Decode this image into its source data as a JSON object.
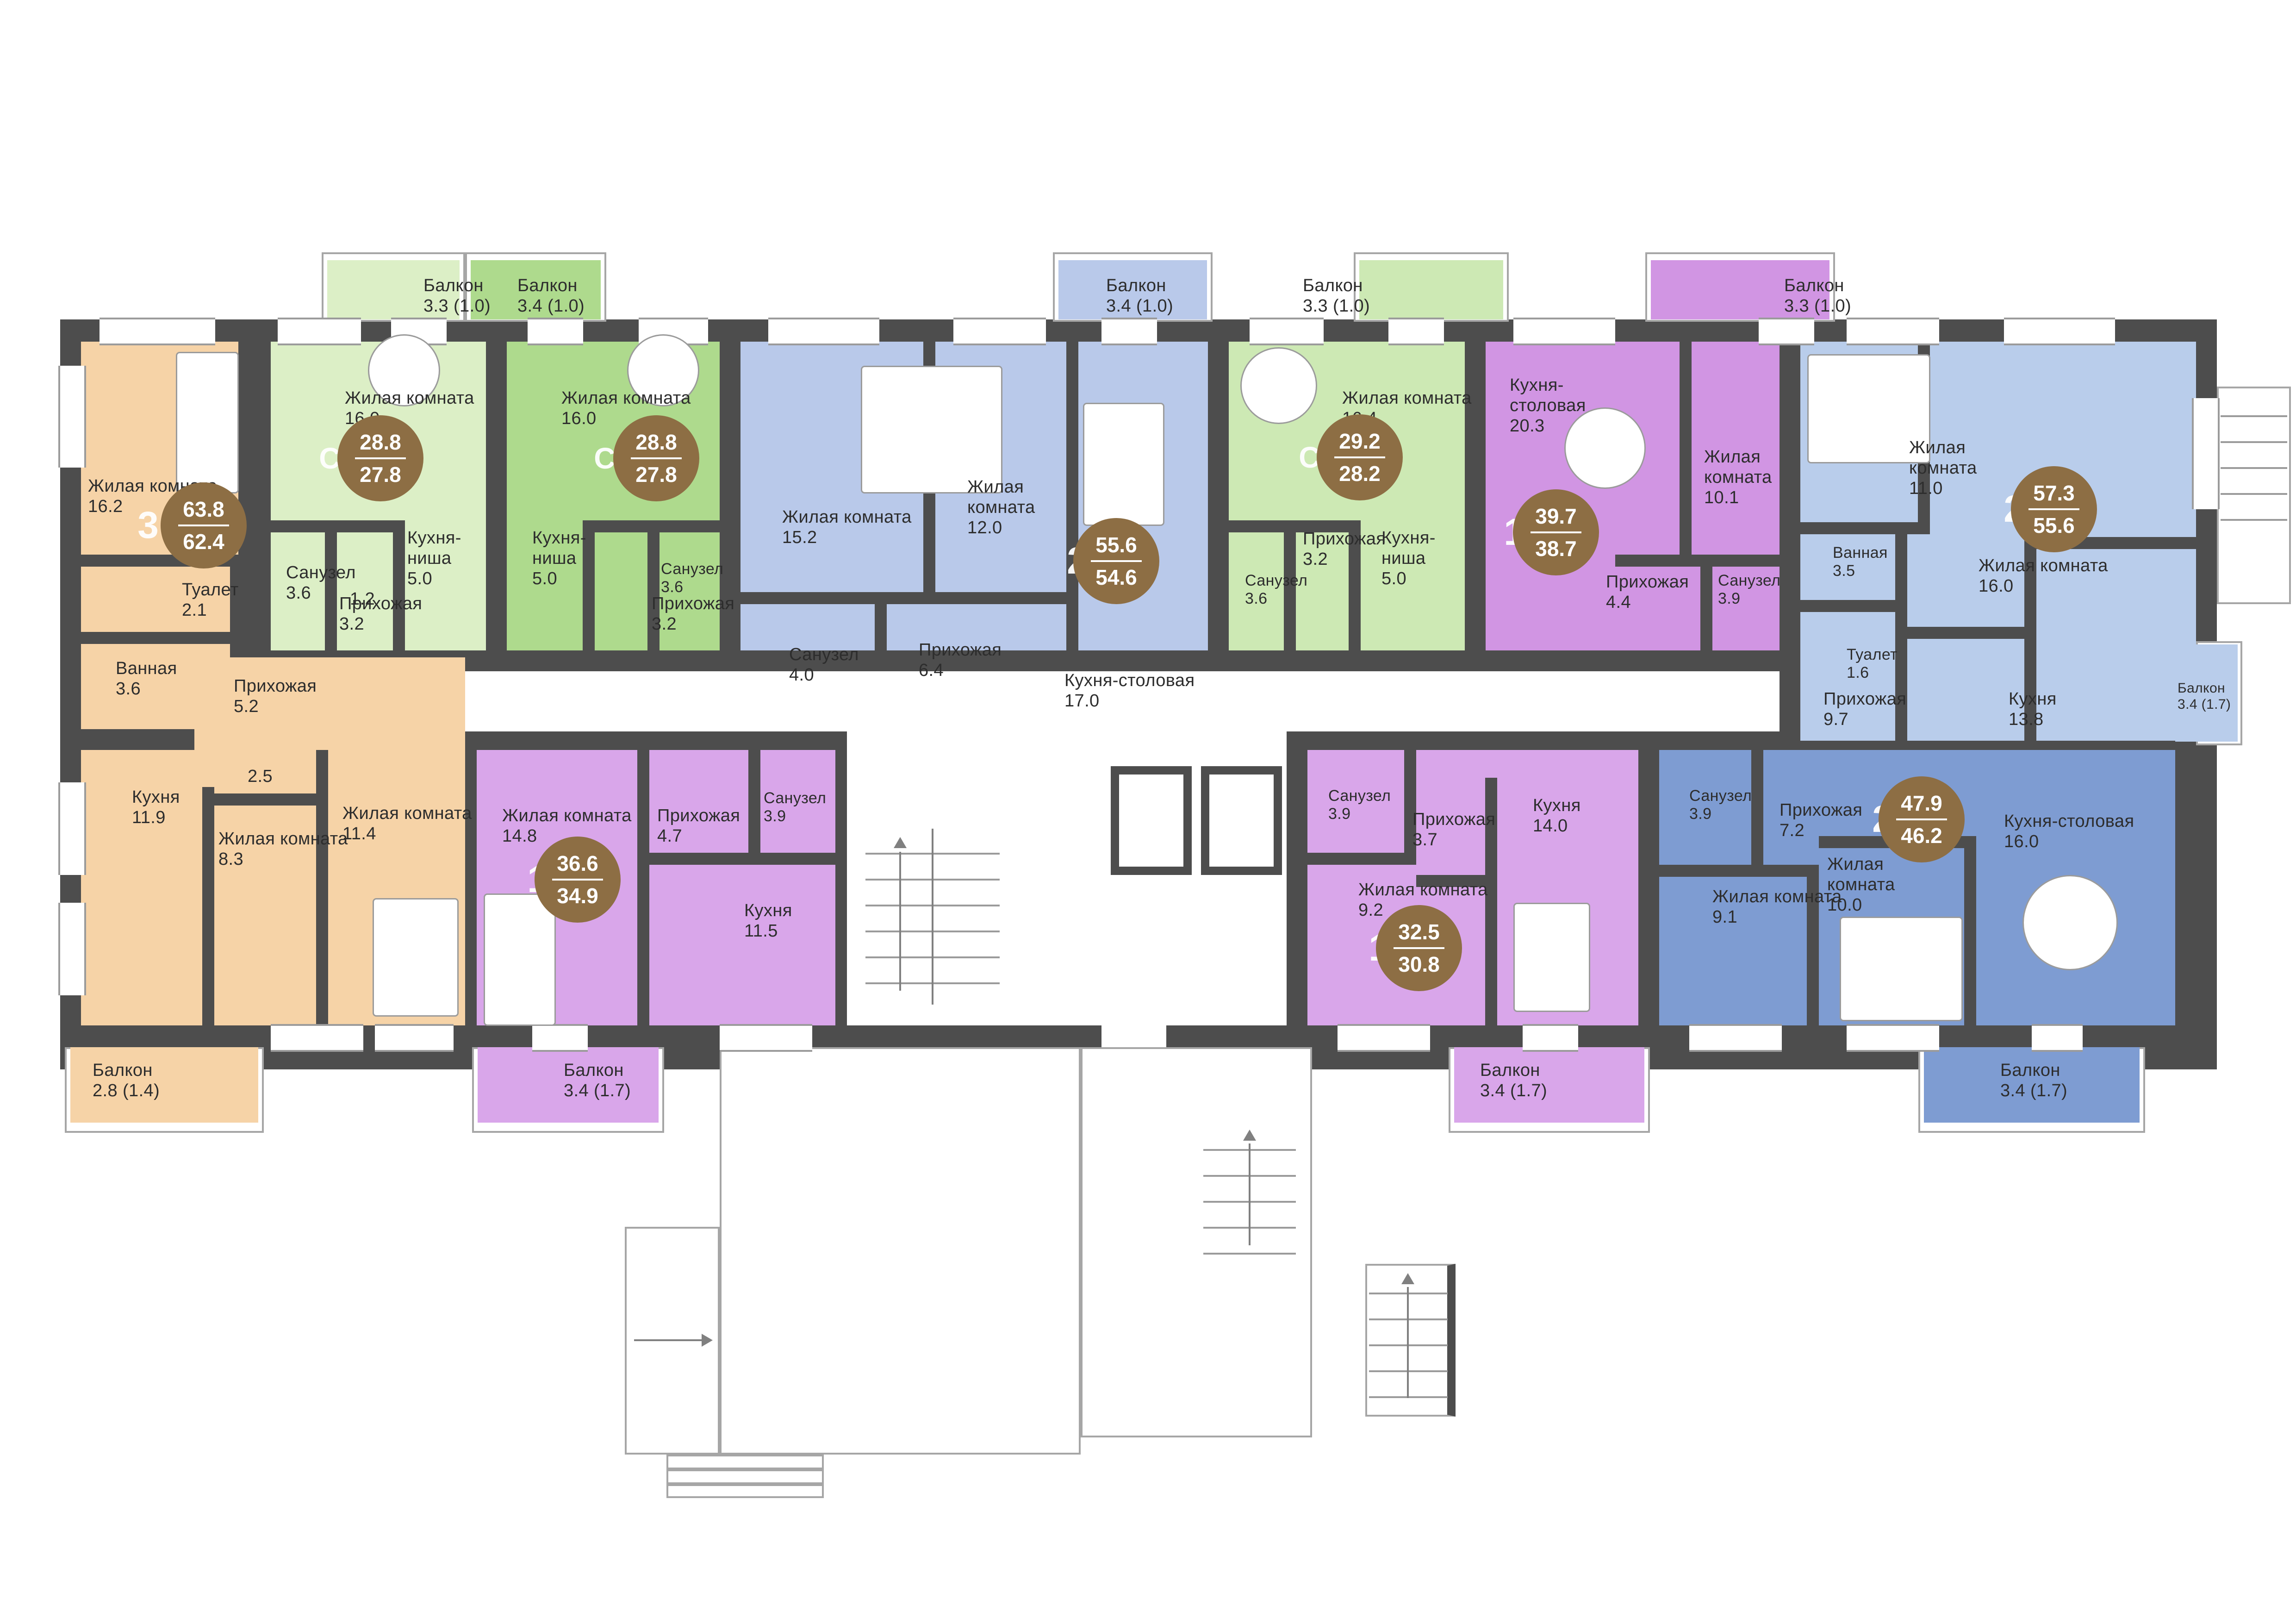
{
  "plan": {
    "background": "#ffffff",
    "wall_color": "#4d4d4d",
    "badge_color": "#8d6e44",
    "apartments": [
      {
        "id": "apt-3r-63-8",
        "type": "3",
        "area_total": "63.8",
        "area_living": "62.4",
        "color": "#f6d3a7",
        "rooms": [
          {
            "name": "Жилая комната",
            "area": "16.2"
          },
          {
            "name": "Туалет",
            "area": "2.1"
          },
          {
            "name": "",
            "area": "1.2"
          },
          {
            "name": "Ванная",
            "area": "3.6"
          },
          {
            "name": "Прихожая",
            "area": "5.2"
          },
          {
            "name": "",
            "area": "2.5"
          },
          {
            "name": "Кухня",
            "area": "11.9"
          },
          {
            "name": "Жилая комната",
            "area": "8.3"
          },
          {
            "name": "Жилая комната",
            "area": "11.4"
          },
          {
            "name": "Балкон",
            "area": "2.8 (1.4)"
          }
        ]
      },
      {
        "id": "apt-st-28-8-a",
        "type": "Ст",
        "area_total": "28.8",
        "area_living": "27.8",
        "color": "#dcefc6",
        "rooms": [
          {
            "name": "Балкон",
            "area": "3.3 (1.0)"
          },
          {
            "name": "Жилая комната",
            "area": "16.0"
          },
          {
            "name": "Санузел",
            "area": "3.6"
          },
          {
            "name": "Кухня-ниша",
            "area": "5.0"
          },
          {
            "name": "Прихожая",
            "area": "3.2"
          }
        ]
      },
      {
        "id": "apt-st-28-8-b",
        "type": "Ст",
        "area_total": "28.8",
        "area_living": "27.8",
        "color": "#aeda8d",
        "rooms": [
          {
            "name": "Балкон",
            "area": "3.4 (1.0)"
          },
          {
            "name": "Жилая комната",
            "area": "16.0"
          },
          {
            "name": "Кухня-ниша",
            "area": "5.0"
          },
          {
            "name": "Прихожая",
            "area": "3.2"
          },
          {
            "name": "Санузел",
            "area": "3.6"
          }
        ]
      },
      {
        "id": "apt-2r-55-6",
        "type": "2",
        "area_total": "55.6",
        "area_living": "54.6",
        "color": "#b9c9ea",
        "rooms": [
          {
            "name": "Балкон",
            "area": "3.4 (1.0)"
          },
          {
            "name": "Жилая комната",
            "area": "15.2"
          },
          {
            "name": "Жилая комната",
            "area": "12.0"
          },
          {
            "name": "Санузел",
            "area": "4.0"
          },
          {
            "name": "Прихожая",
            "area": "6.4"
          },
          {
            "name": "Кухня-столовая",
            "area": "17.0"
          }
        ]
      },
      {
        "id": "apt-st-29-2",
        "type": "Ст",
        "area_total": "29.2",
        "area_living": "28.2",
        "color": "#cde9b4",
        "rooms": [
          {
            "name": "Балкон",
            "area": "3.3 (1.0)"
          },
          {
            "name": "Жилая комната",
            "area": "16.4"
          },
          {
            "name": "Прихожая",
            "area": "3.2"
          },
          {
            "name": "Кухня-ниша",
            "area": "5.0"
          },
          {
            "name": "Санузел",
            "area": "3.6"
          }
        ]
      },
      {
        "id": "apt-1r-39-7",
        "type": "1",
        "area_total": "39.7",
        "area_living": "38.7",
        "color": "#d195e3",
        "rooms": [
          {
            "name": "Балкон",
            "area": "3.3 (1.0)"
          },
          {
            "name": "Кухня-столовая",
            "area": "20.3"
          },
          {
            "name": "Жилая комната",
            "area": "10.1"
          },
          {
            "name": "Прихожая",
            "area": "4.4"
          },
          {
            "name": "Санузел",
            "area": "3.9"
          }
        ]
      },
      {
        "id": "apt-2r-57-3",
        "type": "2",
        "area_total": "57.3",
        "area_living": "55.6",
        "color": "#b9cdeb",
        "rooms": [
          {
            "name": "Жилая комната",
            "area": "11.0"
          },
          {
            "name": "Жилая комната",
            "area": "16.0"
          },
          {
            "name": "Ванная",
            "area": "3.5"
          },
          {
            "name": "Туалет",
            "area": "1.6"
          },
          {
            "name": "Прихожая",
            "area": "9.7"
          },
          {
            "name": "Кухня",
            "area": "13.8"
          },
          {
            "name": "Балкон",
            "area": "3.4 (1.7)"
          }
        ]
      },
      {
        "id": "apt-1r-36-6",
        "type": "1",
        "area_total": "36.6",
        "area_living": "34.9",
        "color": "#d9a6ea",
        "rooms": [
          {
            "name": "Жилая комната",
            "area": "14.8"
          },
          {
            "name": "Прихожая",
            "area": "4.7"
          },
          {
            "name": "Санузел",
            "area": "3.9"
          },
          {
            "name": "Кухня",
            "area": "11.5"
          },
          {
            "name": "Балкон",
            "area": "3.4 (1.7)"
          }
        ]
      },
      {
        "id": "apt-1r-32-5",
        "type": "1",
        "area_total": "32.5",
        "area_living": "30.8",
        "color": "#d9a6ea",
        "rooms": [
          {
            "name": "Санузел",
            "area": "3.9"
          },
          {
            "name": "Прихожая",
            "area": "3.7"
          },
          {
            "name": "Кухня",
            "area": "14.0"
          },
          {
            "name": "Жилая комната",
            "area": "9.2"
          },
          {
            "name": "Балкон",
            "area": "3.4 (1.7)"
          }
        ]
      },
      {
        "id": "apt-2r-47-9",
        "type": "2",
        "area_total": "47.9",
        "area_living": "46.2",
        "color": "#7e9cd2",
        "rooms": [
          {
            "name": "Санузел",
            "area": "3.9"
          },
          {
            "name": "Прихожая",
            "area": "7.2"
          },
          {
            "name": "Кухня-столовая",
            "area": "16.0"
          },
          {
            "name": "Жилая комната",
            "area": "9.1"
          },
          {
            "name": "Жилая комната",
            "area": "10.0"
          },
          {
            "name": "Балкон",
            "area": "3.4 (1.7)"
          }
        ]
      }
    ]
  }
}
